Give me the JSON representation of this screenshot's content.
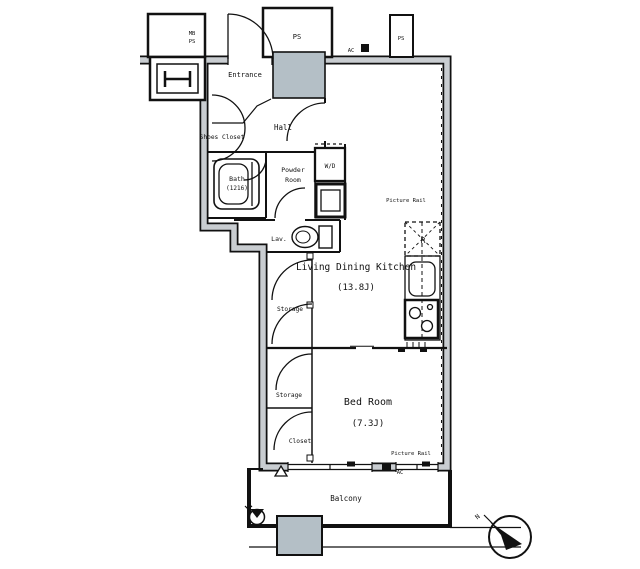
{
  "plan": {
    "rooms": {
      "entrance": "Entrance",
      "hall": "Hall",
      "shoes_closet": "Shoes Closet",
      "bath": "Bath",
      "bath_size": "(1216)",
      "powder_line1": "Powder",
      "powder_line2": "Room",
      "lavatory": "Lav.",
      "ldk": "Living Dining Kitchen",
      "ldk_size": "(13.8J)",
      "storage_upper": "Storage",
      "storage_lower": "Storage",
      "closet": "Closet",
      "bedroom": "Bed Room",
      "bedroom_size": "(7.3J)",
      "balcony": "Balcony"
    },
    "labels": {
      "ps_top": "PS",
      "ps_right": "PS",
      "meter_box_line1": "MB",
      "meter_box_line2": "PS",
      "washer_dryer": "W/D",
      "refrigerator": "R",
      "picture_rail_top": "Picture Rail",
      "picture_rail_bottom": "Picture Rail",
      "ac_top": "AC",
      "ac_bottom": "AC",
      "compass_north": "N"
    },
    "colors": {
      "line": "#111111",
      "wall_core": "#c9cdd1",
      "shaft_fill": "#b4bfc6"
    }
  }
}
